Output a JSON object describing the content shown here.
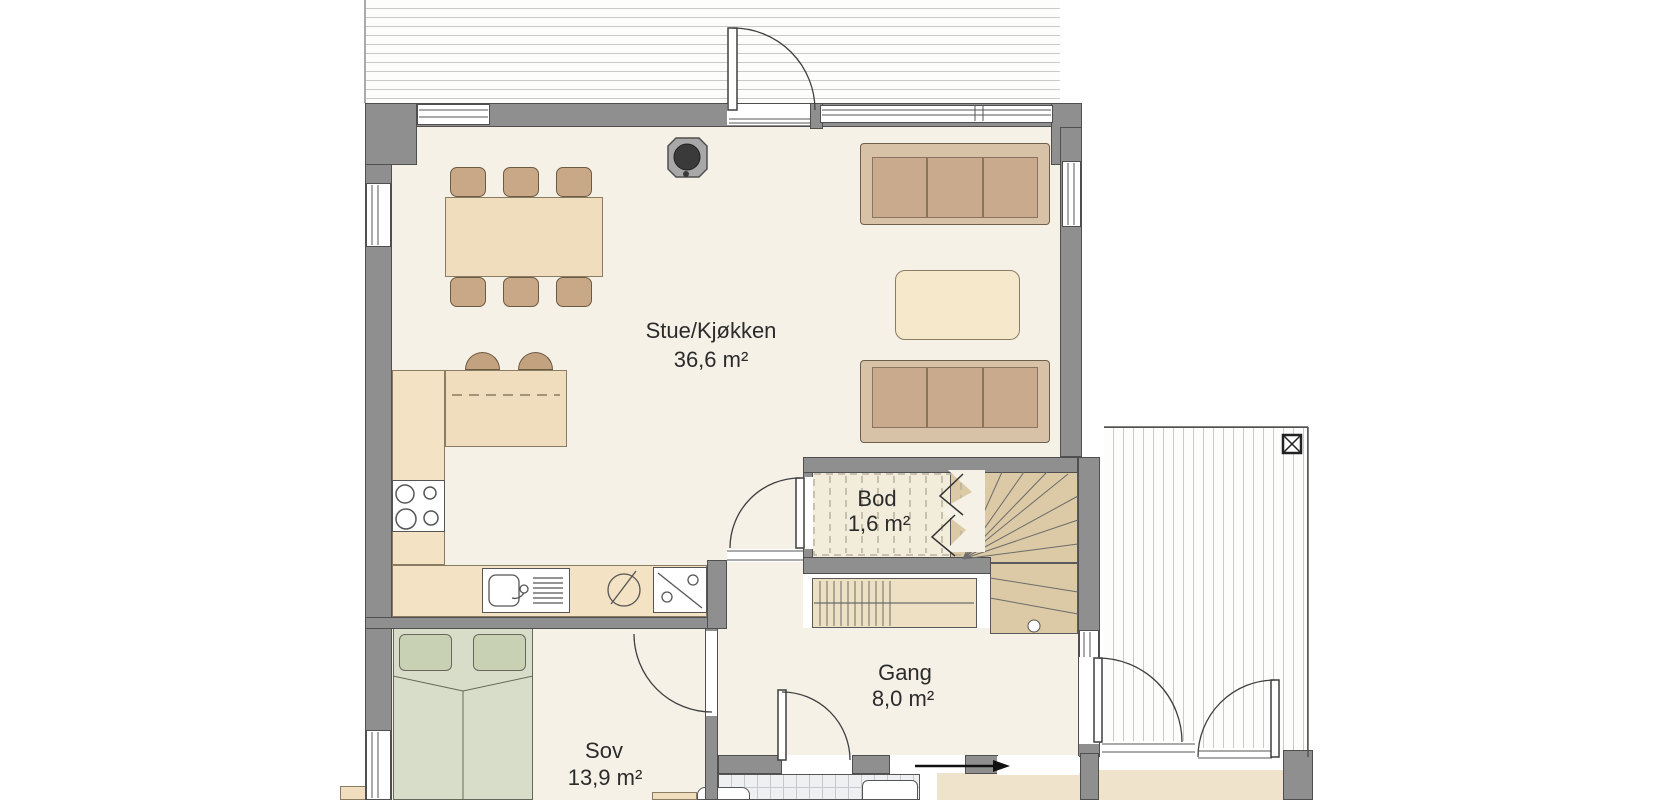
{
  "plan": {
    "title": "First floor plan",
    "rooms": [
      {
        "name": "Stue/Kjøkken",
        "area": "36,6 m²"
      },
      {
        "name": "Bod",
        "area": "1,6 m²"
      },
      {
        "name": "Gang",
        "area": "8,0 m²"
      },
      {
        "name": "Sov",
        "area": "13,9 m²"
      }
    ],
    "colors": {
      "wall": "#8f8f8f",
      "floor": "#f5f1e6",
      "furniture_wood": "#efddbe",
      "upholstery": "#c9aa8c",
      "bed_green": "#d8ddc9",
      "deck_line": "#c9c9c9"
    },
    "symbols": {
      "stove": "wood-stove-icon",
      "post": "deck-post-icon",
      "arrow": "entry-direction-arrow",
      "stair_break": "stair-cut-zigzag"
    }
  }
}
